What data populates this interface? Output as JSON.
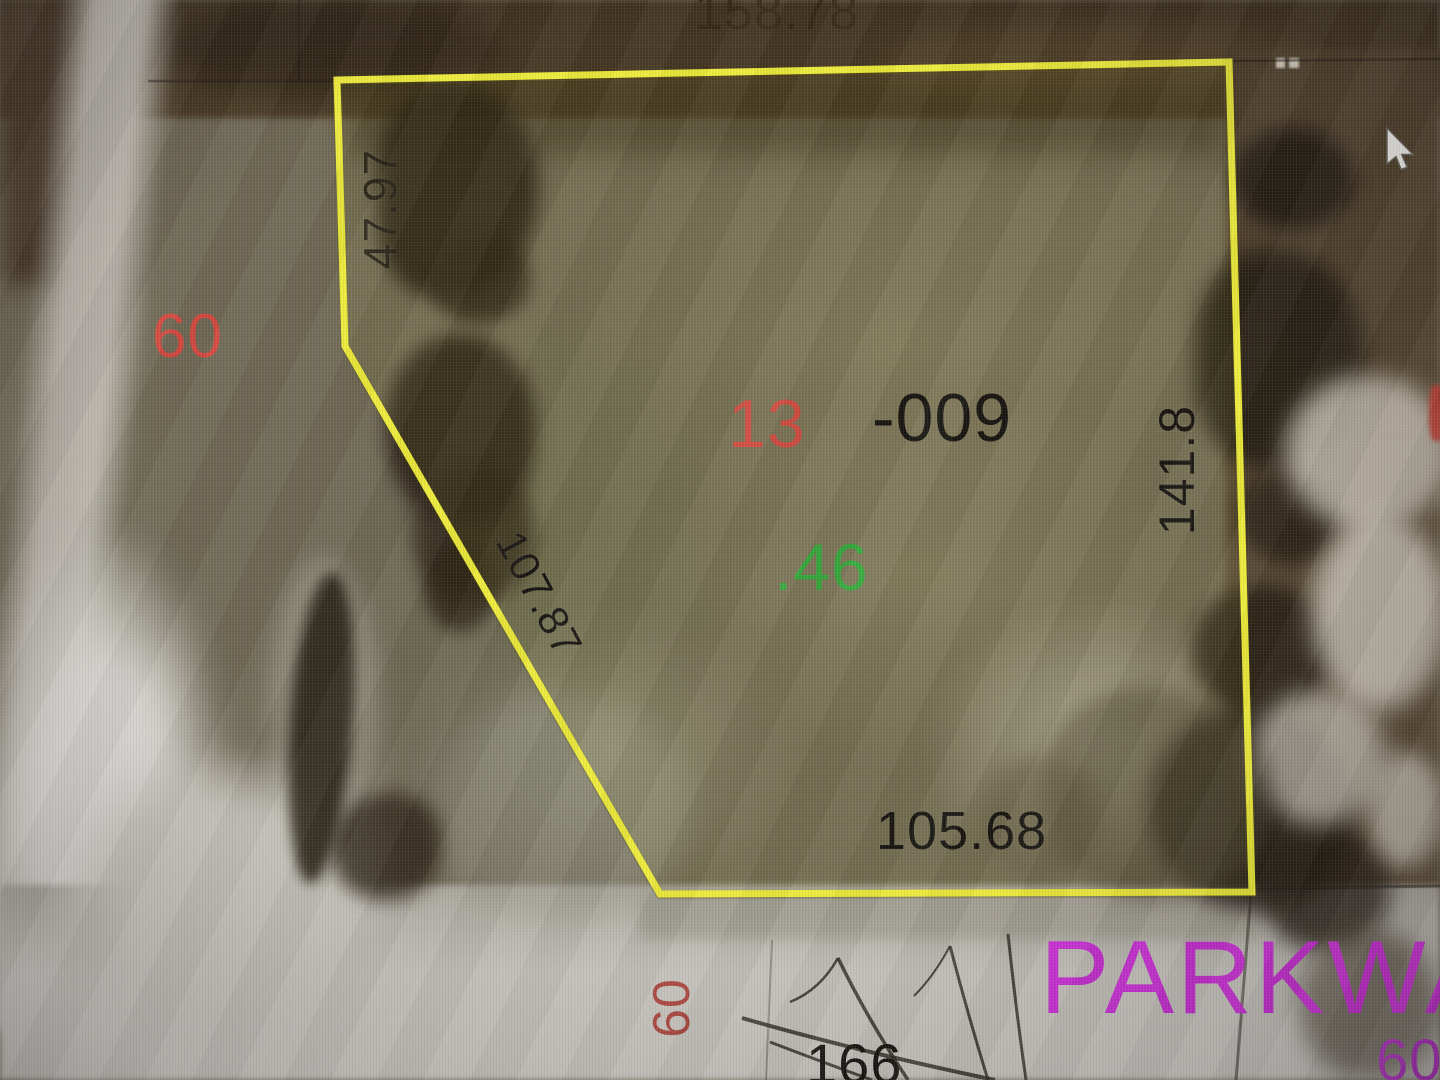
{
  "map": {
    "canvas_role": "aerial parcel map view"
  },
  "parcel": {
    "lot_number": "13",
    "parcel_id_suffix": "-009",
    "acreage": ".46",
    "boundary_points": "337,80 1229,62 1252,892 660,894 345,346",
    "boundary_color": "#ecea38",
    "dimensions": {
      "north": "158.78",
      "west": "47.97",
      "southwest": "107.87",
      "south": "105.68",
      "east": "141.8"
    }
  },
  "roads": {
    "west_width_label": "60",
    "south_width_label": "60",
    "corner_width_label": "60",
    "south_lot_label": "166",
    "street_name_partial": "PARKWA"
  },
  "colors": {
    "boundary_yellow": "#ecea38",
    "lot_number_red": "#e0453c",
    "road_width_red": "#e0453c",
    "road_width_dark_red": "#a83a31",
    "acreage_green": "#2fae39",
    "street_magenta": "#cb2ed6",
    "dimension_black": "#17140f",
    "faint_dimension_brown": "#30240f"
  }
}
